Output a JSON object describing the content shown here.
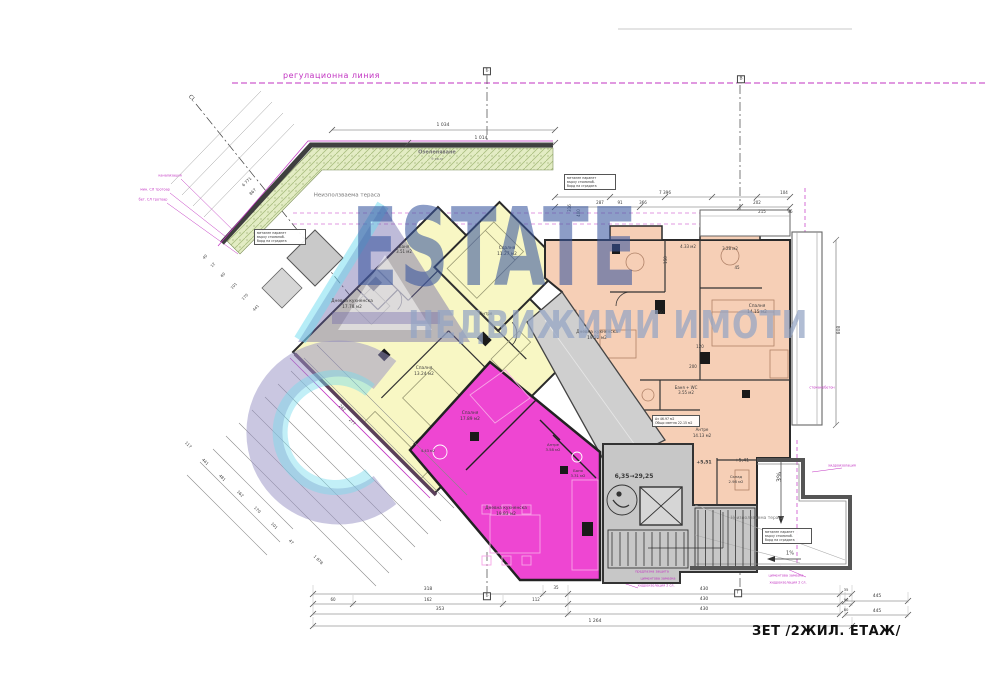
{
  "watermark": {
    "brand": "ESTATE",
    "subtitle": "НЕДВИЖИМИ ИМОТИ"
  },
  "plan": {
    "regulation_line_label": "регулационна линия",
    "drawing_title": "ЗЕТ /2ЖИЛ. ЕТАЖ/"
  },
  "colors": {
    "apartment_yellow": "#f8f7c4",
    "apartment_orange": "#f6cfb6",
    "apartment_magenta": "#ee46d2",
    "terrace_green": "#e3ecc4",
    "core_gray": "#c7c7c7",
    "watermark_blue": "#39579e",
    "annotation_magenta": "#c233c2"
  },
  "notes": [
    {
      "x": 280,
      "y": 237,
      "w": 46,
      "lines": [
        "метален парапет",
        "върху стоманоб.",
        "борд на сградата"
      ]
    },
    {
      "x": 590,
      "y": 182,
      "w": 46,
      "lines": [
        "метален парапет",
        "върху стоманоб.",
        "борд на сградата"
      ]
    },
    {
      "x": 787,
      "y": 536,
      "w": 44,
      "lines": [
        "метален парапет",
        "върху стоманоб.",
        "борд на сградата"
      ]
    },
    {
      "x": 676,
      "y": 421,
      "w": 42,
      "lines": [
        "Аз 46.97 м2",
        "Общо светла 22.15 м2"
      ]
    }
  ],
  "labels": [
    {
      "t": "1 034",
      "x": 443,
      "y": 126,
      "s": 4.5
    },
    {
      "t": "1 014",
      "x": 481,
      "y": 139,
      "s": 4.5
    },
    {
      "t": "7 396",
      "x": 665,
      "y": 193,
      "s": 4.2
    },
    {
      "t": "91",
      "x": 620,
      "y": 203,
      "s": 4
    },
    {
      "t": "366",
      "x": 643,
      "y": 203,
      "s": 4
    },
    {
      "t": "287",
      "x": 600,
      "y": 203,
      "s": 4
    },
    {
      "t": "202",
      "x": 757,
      "y": 203,
      "s": 4
    },
    {
      "t": "104",
      "x": 784,
      "y": 193,
      "s": 4
    },
    {
      "t": "215",
      "x": 762,
      "y": 212,
      "s": 4
    },
    {
      "t": "96",
      "x": 790,
      "y": 212,
      "s": 4
    },
    {
      "t": "316",
      "x": 570,
      "y": 208,
      "s": 4,
      "r": -90
    },
    {
      "t": "400",
      "x": 579,
      "y": 213,
      "s": 4,
      "r": -90
    },
    {
      "t": "150",
      "x": 666,
      "y": 260,
      "s": 4,
      "r": -90
    },
    {
      "t": "808",
      "x": 840,
      "y": 330,
      "s": 4.5,
      "r": -90
    },
    {
      "t": "350",
      "x": 660,
      "y": 313,
      "s": 4
    },
    {
      "t": "120",
      "x": 700,
      "y": 347,
      "s": 4
    },
    {
      "t": "200",
      "x": 693,
      "y": 367,
      "s": 4
    },
    {
      "t": "45",
      "x": 737,
      "y": 268,
      "s": 4
    },
    {
      "t": "318",
      "x": 428,
      "y": 590,
      "s": 4.5
    },
    {
      "t": "35",
      "x": 556,
      "y": 588,
      "s": 4
    },
    {
      "t": "430",
      "x": 704,
      "y": 590,
      "s": 4.5
    },
    {
      "t": "60",
      "x": 333,
      "y": 600,
      "s": 4
    },
    {
      "t": "162",
      "x": 428,
      "y": 600,
      "s": 4
    },
    {
      "t": "112",
      "x": 536,
      "y": 600,
      "s": 4
    },
    {
      "t": "430",
      "x": 704,
      "y": 600,
      "s": 4.5
    },
    {
      "t": "353",
      "x": 440,
      "y": 610,
      "s": 4.5
    },
    {
      "t": "430",
      "x": 704,
      "y": 610,
      "s": 4.5
    },
    {
      "t": "1 264",
      "x": 595,
      "y": 622,
      "s": 4.5
    },
    {
      "t": "445",
      "x": 877,
      "y": 597,
      "s": 4.5
    },
    {
      "t": "445",
      "x": 877,
      "y": 612,
      "s": 4.5
    },
    {
      "t": "35",
      "x": 846,
      "y": 590,
      "s": 3.8
    },
    {
      "t": "90",
      "x": 846,
      "y": 600,
      "s": 3.8
    },
    {
      "t": "80",
      "x": 846,
      "y": 610,
      "s": 3.8
    },
    {
      "t": "117",
      "x": 188,
      "y": 445,
      "s": 4,
      "r": 45
    },
    {
      "t": "441",
      "x": 205,
      "y": 462,
      "s": 4,
      "r": 45
    },
    {
      "t": "481",
      "x": 222,
      "y": 478,
      "s": 4,
      "r": 45
    },
    {
      "t": "162",
      "x": 240,
      "y": 494,
      "s": 4,
      "r": 45
    },
    {
      "t": "170",
      "x": 257,
      "y": 510,
      "s": 4,
      "r": 45
    },
    {
      "t": "101",
      "x": 274,
      "y": 526,
      "s": 4,
      "r": 45
    },
    {
      "t": "47",
      "x": 291,
      "y": 542,
      "s": 4,
      "r": 45
    },
    {
      "t": "1 878",
      "x": 318,
      "y": 560,
      "s": 4,
      "r": 45
    },
    {
      "t": "277",
      "x": 352,
      "y": 422,
      "s": 4,
      "r": 45
    },
    {
      "t": "242",
      "x": 342,
      "y": 408,
      "s": 4,
      "r": 45
    },
    {
      "t": "6 771",
      "x": 247,
      "y": 182,
      "s": 4,
      "r": -45
    },
    {
      "t": "867",
      "x": 253,
      "y": 192,
      "s": 4,
      "r": -45
    },
    {
      "t": "40",
      "x": 205,
      "y": 257,
      "s": 3.8,
      "r": -45
    },
    {
      "t": "12",
      "x": 213,
      "y": 265,
      "s": 3.8,
      "r": -45
    },
    {
      "t": "60",
      "x": 223,
      "y": 275,
      "s": 3.8,
      "r": -45
    },
    {
      "t": "101",
      "x": 234,
      "y": 286,
      "s": 3.8,
      "r": -45
    },
    {
      "t": "170",
      "x": 245,
      "y": 297,
      "s": 3.8,
      "r": -45
    },
    {
      "t": "441",
      "x": 256,
      "y": 308,
      "s": 3.8,
      "r": -45
    },
    {
      "t": "Дневна кухненска",
      "x": 352,
      "y": 302,
      "s": 4.3
    },
    {
      "t": "17.78 м2",
      "x": 352,
      "y": 308,
      "s": 4.3
    },
    {
      "t": "Спалня",
      "x": 424,
      "y": 369,
      "s": 4.3
    },
    {
      "t": "13.24 м2",
      "x": 424,
      "y": 375,
      "s": 4.3
    },
    {
      "t": "Баня",
      "x": 404,
      "y": 247,
      "s": 4
    },
    {
      "t": "3.51 м2",
      "x": 404,
      "y": 252,
      "s": 4
    },
    {
      "t": "Спалня",
      "x": 507,
      "y": 249,
      "s": 4.3
    },
    {
      "t": "11.27 м2",
      "x": 507,
      "y": 255,
      "s": 4.3
    },
    {
      "t": "Антре",
      "x": 486,
      "y": 314,
      "s": 4
    },
    {
      "t": "Дневна кухненска",
      "x": 597,
      "y": 333,
      "s": 4.3
    },
    {
      "t": "19.22 м2",
      "x": 597,
      "y": 339,
      "s": 4.3
    },
    {
      "t": "Спалня",
      "x": 757,
      "y": 307,
      "s": 4.3
    },
    {
      "t": "14.15 м2",
      "x": 757,
      "y": 313,
      "s": 4.3
    },
    {
      "t": "4.33 м2",
      "x": 688,
      "y": 247,
      "s": 4
    },
    {
      "t": "3.28 м2",
      "x": 730,
      "y": 249,
      "s": 4
    },
    {
      "t": "Баня + WC",
      "x": 686,
      "y": 388,
      "s": 4
    },
    {
      "t": "3.55 м2",
      "x": 686,
      "y": 393,
      "s": 4
    },
    {
      "t": "Антре",
      "x": 702,
      "y": 430,
      "s": 4
    },
    {
      "t": "14.13 м2",
      "x": 702,
      "y": 436,
      "s": 4
    },
    {
      "t": "Склад",
      "x": 736,
      "y": 477,
      "s": 3.8
    },
    {
      "t": "2.98 м2",
      "x": 736,
      "y": 482,
      "s": 3.8
    },
    {
      "t": "Спалня",
      "x": 470,
      "y": 414,
      "s": 4.3
    },
    {
      "t": "17.89 м2",
      "x": 470,
      "y": 420,
      "s": 4.3
    },
    {
      "t": "Антре",
      "x": 553,
      "y": 445,
      "s": 3.8
    },
    {
      "t": "3.58 м2",
      "x": 553,
      "y": 450,
      "s": 3.8
    },
    {
      "t": "Баня",
      "x": 578,
      "y": 471,
      "s": 3.8
    },
    {
      "t": "3.31 м2",
      "x": 578,
      "y": 476,
      "s": 3.8
    },
    {
      "t": "Дневна кухненска",
      "x": 506,
      "y": 509,
      "s": 4.3
    },
    {
      "t": "19.83 м2",
      "x": 506,
      "y": 515,
      "s": 4.3
    },
    {
      "t": "4.43 м2",
      "x": 428,
      "y": 452,
      "s": 3.6
    },
    {
      "t": "6,35→29,25",
      "x": 634,
      "y": 477,
      "s": 6,
      "w": 700
    },
    {
      "t": "+5,51",
      "x": 704,
      "y": 464,
      "s": 4.6,
      "w": 700
    },
    {
      "t": "+5,41",
      "x": 742,
      "y": 462,
      "s": 4.6
    },
    {
      "t": "Неизползваема тераса",
      "x": 347,
      "y": 196,
      "s": 5.5,
      "c": "ter"
    },
    {
      "t": "Неизползваема тераса",
      "x": 757,
      "y": 519,
      "s": 4.4,
      "c": "ter"
    },
    {
      "t": "Озеленяване",
      "x": 437,
      "y": 153,
      "s": 5,
      "w": 700,
      "c": "ter"
    },
    {
      "t": "9 кв.м",
      "x": 437,
      "y": 160,
      "s": 3.6,
      "c": "ter"
    },
    {
      "t": "3%",
      "x": 779,
      "y": 477,
      "s": 6.5,
      "r": -90
    },
    {
      "t": "1%",
      "x": 790,
      "y": 554,
      "s": 5
    },
    {
      "t": "CL",
      "x": 191,
      "y": 99,
      "s": 5.5,
      "r": 45
    },
    {
      "t": "Б",
      "x": 487,
      "y": 71,
      "s": 4.5,
      "bx": 1
    },
    {
      "t": "В",
      "x": 741,
      "y": 79,
      "s": 4.5,
      "bx": 1
    },
    {
      "t": "Б",
      "x": 487,
      "y": 596,
      "s": 4.5,
      "bx": 1
    },
    {
      "t": "Г",
      "x": 738,
      "y": 593,
      "s": 4.5,
      "bx": 1
    },
    {
      "t": "канализация",
      "x": 170,
      "y": 176,
      "s": 3.4,
      "c": "mag"
    },
    {
      "t": "мин. СЛ тротоар",
      "x": 155,
      "y": 190,
      "s": 3.4,
      "c": "mag"
    },
    {
      "t": "бет. СЛ тротоар",
      "x": 153,
      "y": 200,
      "s": 3.4,
      "c": "mag"
    },
    {
      "t": "предпазна защита",
      "x": 652,
      "y": 572,
      "s": 3.4,
      "c": "mag"
    },
    {
      "t": "циментова замазка",
      "x": 658,
      "y": 579,
      "s": 3.4,
      "c": "mag"
    },
    {
      "t": "хидроизолация 2 сл.",
      "x": 656,
      "y": 586,
      "s": 3.4,
      "c": "mag"
    },
    {
      "t": "хидроизолация",
      "x": 842,
      "y": 466,
      "s": 3.4,
      "c": "mag"
    },
    {
      "t": "циментова замазка",
      "x": 786,
      "y": 576,
      "s": 3.4,
      "c": "mag"
    },
    {
      "t": "хидроизолация 2 сл.",
      "x": 788,
      "y": 583,
      "s": 3.4,
      "c": "mag"
    },
    {
      "t": "стоманобетон",
      "x": 822,
      "y": 388,
      "s": 3.4,
      "c": "mag"
    }
  ]
}
